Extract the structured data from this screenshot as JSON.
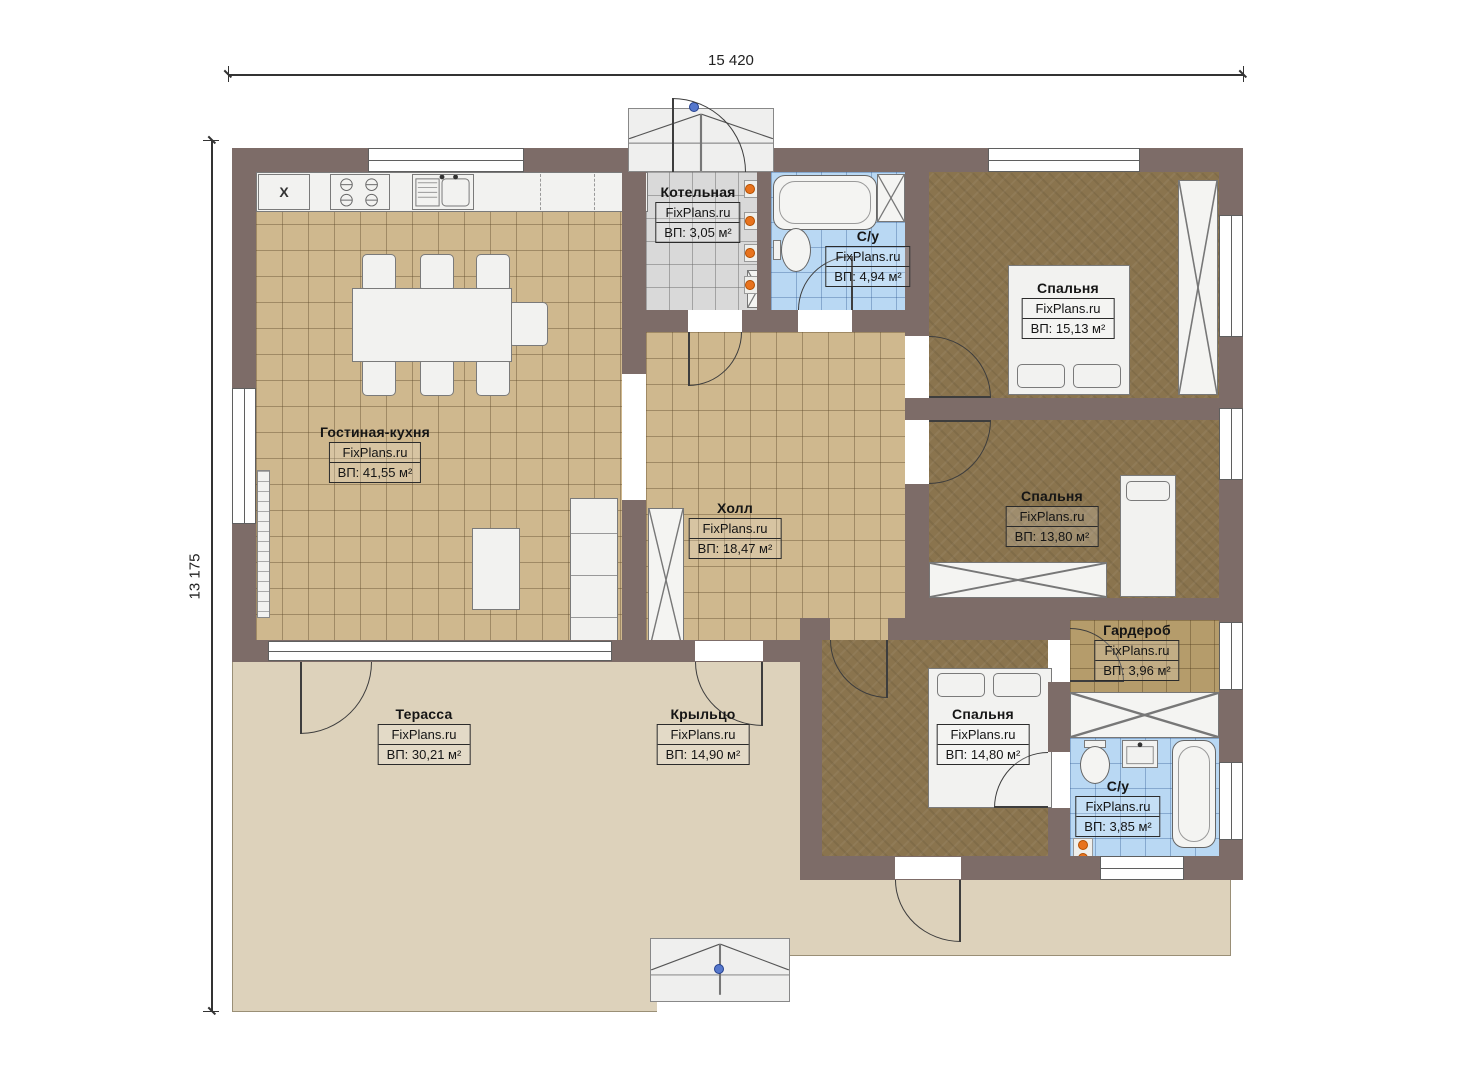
{
  "brand": "FixPlans.ru",
  "dimensions": {
    "width_label": "15 420",
    "height_label": "13 175"
  },
  "symbols": {
    "cabinet_mark": "X"
  },
  "colors": {
    "wall": "#7d6c68",
    "floor_living_tile": "#cfb88e",
    "floor_bedroom": "#8a744e",
    "floor_bathroom_tile": "#b9d8f3",
    "floor_boiler_tile": "#d9d9d9",
    "floor_wardrobe_tile": "#b59c6b",
    "terrace": "#ddd2bb",
    "radiator_orange": "#e8731e",
    "door_axis_marker": "#5577cc"
  },
  "rooms": [
    {
      "name": "Котельная",
      "brand": "FixPlans.ru",
      "area": "ВП: 3,05 м²"
    },
    {
      "name": "С/у",
      "brand": "FixPlans.ru",
      "area": "ВП: 4,94 м²"
    },
    {
      "name": "Спальня",
      "brand": "FixPlans.ru",
      "area": "ВП: 15,13 м²"
    },
    {
      "name": "Гостиная-кухня",
      "brand": "FixPlans.ru",
      "area": "ВП: 41,55 м²"
    },
    {
      "name": "Холл",
      "brand": "FixPlans.ru",
      "area": "ВП: 18,47 м²"
    },
    {
      "name": "Спальня",
      "brand": "FixPlans.ru",
      "area": "ВП: 13,80 м²"
    },
    {
      "name": "Гардероб",
      "brand": "FixPlans.ru",
      "area": "ВП: 3,96 м²"
    },
    {
      "name": "Спальня",
      "brand": "FixPlans.ru",
      "area": "ВП: 14,80 м²"
    },
    {
      "name": "С/у",
      "brand": "FixPlans.ru",
      "area": "ВП: 3,85 м²"
    },
    {
      "name": "Терасса",
      "brand": "FixPlans.ru",
      "area": "ВП: 30,21 м²"
    },
    {
      "name": "Крыльцо",
      "brand": "FixPlans.ru",
      "area": "ВП: 14,90 м²"
    }
  ]
}
